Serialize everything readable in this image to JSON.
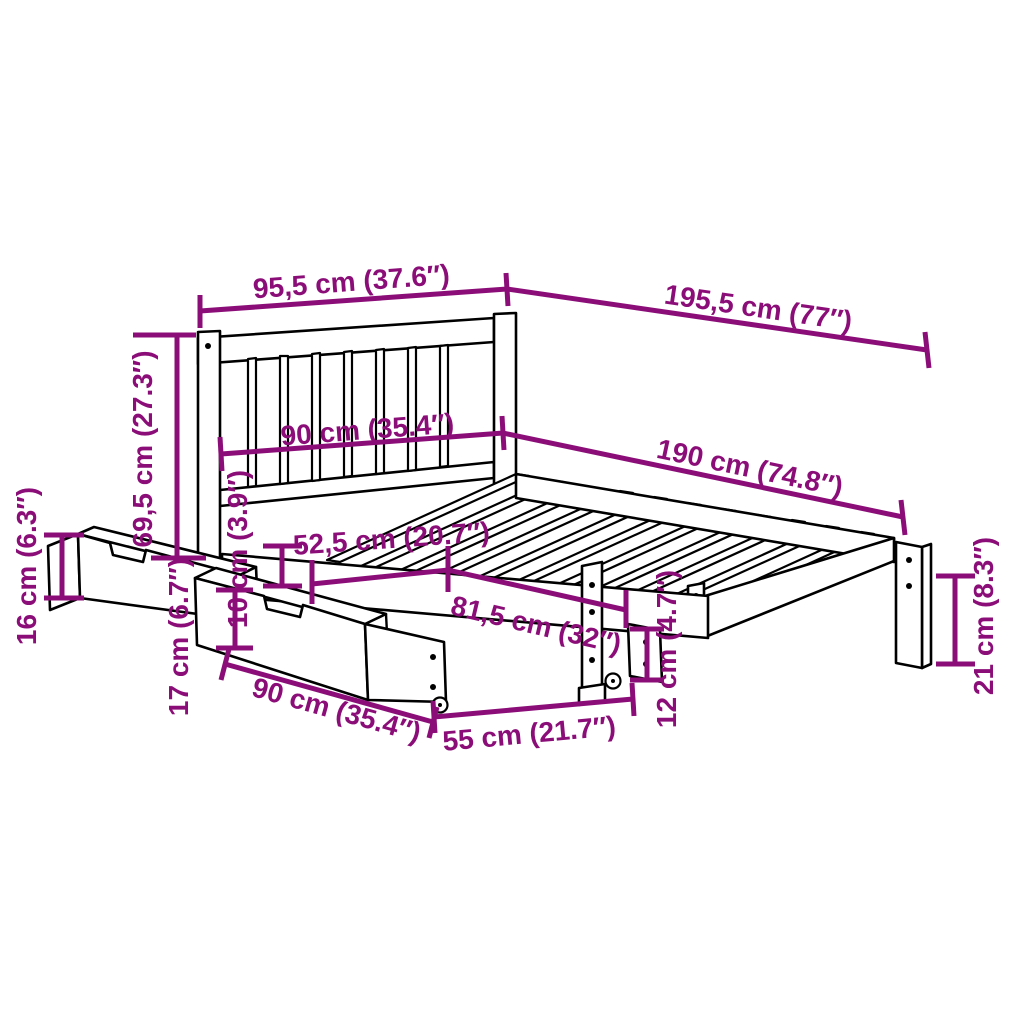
{
  "diagram": {
    "kind": "product-dimension-diagram",
    "subject": "bed-frame-with-headboard-and-two-underbed-storage-drawers",
    "colors": {
      "background": "#ffffff",
      "line": "#000000",
      "dimension": "#8B0E78"
    },
    "units": {
      "primary": "cm",
      "secondary": "inches"
    },
    "dimensions": [
      {
        "id": "headboard-width",
        "label": "95,5 cm (37.6″)",
        "cm": 95.5,
        "inches": 37.6,
        "orientation": "horizontal"
      },
      {
        "id": "total-length",
        "label": "195,5 cm (77″)",
        "cm": 195.5,
        "inches": 77,
        "orientation": "horizontal"
      },
      {
        "id": "bed-width",
        "label": "90 cm (35.4″)",
        "cm": 90,
        "inches": 35.4,
        "orientation": "horizontal"
      },
      {
        "id": "bed-length",
        "label": "190 cm (74.8″)",
        "cm": 190,
        "inches": 74.8,
        "orientation": "horizontal"
      },
      {
        "id": "headboard-height",
        "label": "69,5 cm (27.3″)",
        "cm": 69.5,
        "inches": 27.3,
        "orientation": "vertical"
      },
      {
        "id": "drawer-front-height",
        "label": "16 cm (6.3″)",
        "cm": 16,
        "inches": 6.3,
        "orientation": "vertical"
      },
      {
        "id": "drawer-top-depth",
        "label": "52,5 cm (20.7″)",
        "cm": 52.5,
        "inches": 20.7,
        "orientation": "horizontal"
      },
      {
        "id": "side-rail-height",
        "label": "10 cm (3.9″)",
        "cm": 10,
        "inches": 3.9,
        "orientation": "vertical"
      },
      {
        "id": "drawer-side-height",
        "label": "17 cm (6.7″)",
        "cm": 17,
        "inches": 6.7,
        "orientation": "vertical"
      },
      {
        "id": "drawer-length",
        "label": "90 cm (35.4″)",
        "cm": 90,
        "inches": 35.4,
        "orientation": "horizontal"
      },
      {
        "id": "drawer-depth",
        "label": "55 cm (21.7″)",
        "cm": 55,
        "inches": 21.7,
        "orientation": "horizontal"
      },
      {
        "id": "drawer-inner-length",
        "label": "81,5 cm (32″)",
        "cm": 81.5,
        "inches": 32,
        "orientation": "horizontal"
      },
      {
        "id": "underbed-clearance",
        "label": "12 cm (4.7″)",
        "cm": 12,
        "inches": 4.7,
        "orientation": "vertical"
      },
      {
        "id": "leg-height",
        "label": "21 cm (8.3″)",
        "cm": 21,
        "inches": 8.3,
        "orientation": "vertical"
      }
    ]
  }
}
